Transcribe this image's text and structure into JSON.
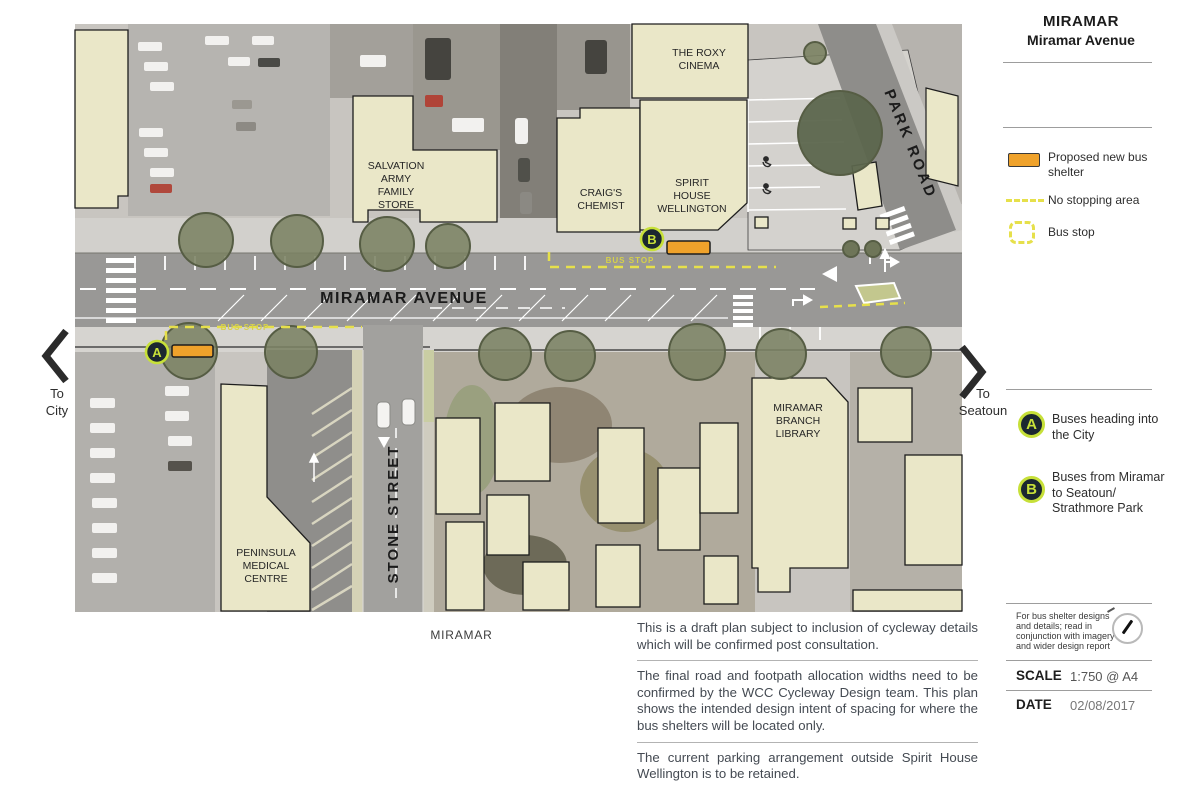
{
  "panel": {
    "title_line1": "MIRAMAR",
    "title_line2": "Miramar Avenue",
    "legend": {
      "shelter_line1": "Proposed new bus",
      "shelter_line2": "shelter",
      "no_stopping": "No stopping area",
      "bus_stop": "Bus stop"
    },
    "routes": {
      "a_letter": "A",
      "a_line1": "Buses heading into",
      "a_line2": "the City",
      "b_letter": "B",
      "b_line1": "Buses from Miramar",
      "b_line2": "to Seatoun/",
      "b_line3": "Strathmore Park"
    },
    "infobox": {
      "note_line1": "For bus shelter designs",
      "note_line2": "and details; read in",
      "note_line3": "conjunction with imagery",
      "note_line4": "and wider design report",
      "scale_label": "SCALE",
      "scale_value": "1:750 @ A4",
      "date_label": "DATE",
      "date_value": "02/08/2017"
    }
  },
  "notes": {
    "para1": "This is a draft plan subject to inclusion of cycleway details which will be confirmed post consultation.",
    "para2": "The final road and footpath allocation widths need to be confirmed by the WCC Cycleway Design team. This plan shows the intended design intent of spacing for where the bus shelters will be located only.",
    "para3": "The current parking arrangement outside Spirit House Wellington is to be retained."
  },
  "directions": {
    "left_line1": "To",
    "left_line2": "City",
    "right_line1": "To",
    "right_line2": "Seatoun"
  },
  "map": {
    "street_miramar": "MIRAMAR AVENUE",
    "street_park": "PARK ROAD",
    "street_stone": "STONE STREET",
    "suburb_caption": "MIRAMAR",
    "bus_stop_marking": "BUS STOP",
    "buildings": {
      "roxy": [
        "THE ROXY",
        "CINEMA"
      ],
      "salvation": [
        "SALVATION",
        "ARMY",
        "FAMILY",
        "STORE"
      ],
      "craigs": [
        "CRAIG'S",
        "CHEMIST"
      ],
      "spirit": [
        "SPIRIT",
        "HOUSE",
        "WELLINGTON"
      ],
      "library": [
        "MIRAMAR",
        "BRANCH",
        "LIBRARY"
      ],
      "peninsula": [
        "PENINSULA",
        "MEDICAL",
        "CENTRE"
      ]
    }
  },
  "colors": {
    "shelter": "#efa22b",
    "marker_fill": "#1b2730",
    "marker_ring": "#c7e039",
    "no_stopping": "#e6e04b",
    "building": "#eae7c8",
    "road": "#999896",
    "sidewalk": "#d4d2ce",
    "tree": "#7b8263"
  }
}
